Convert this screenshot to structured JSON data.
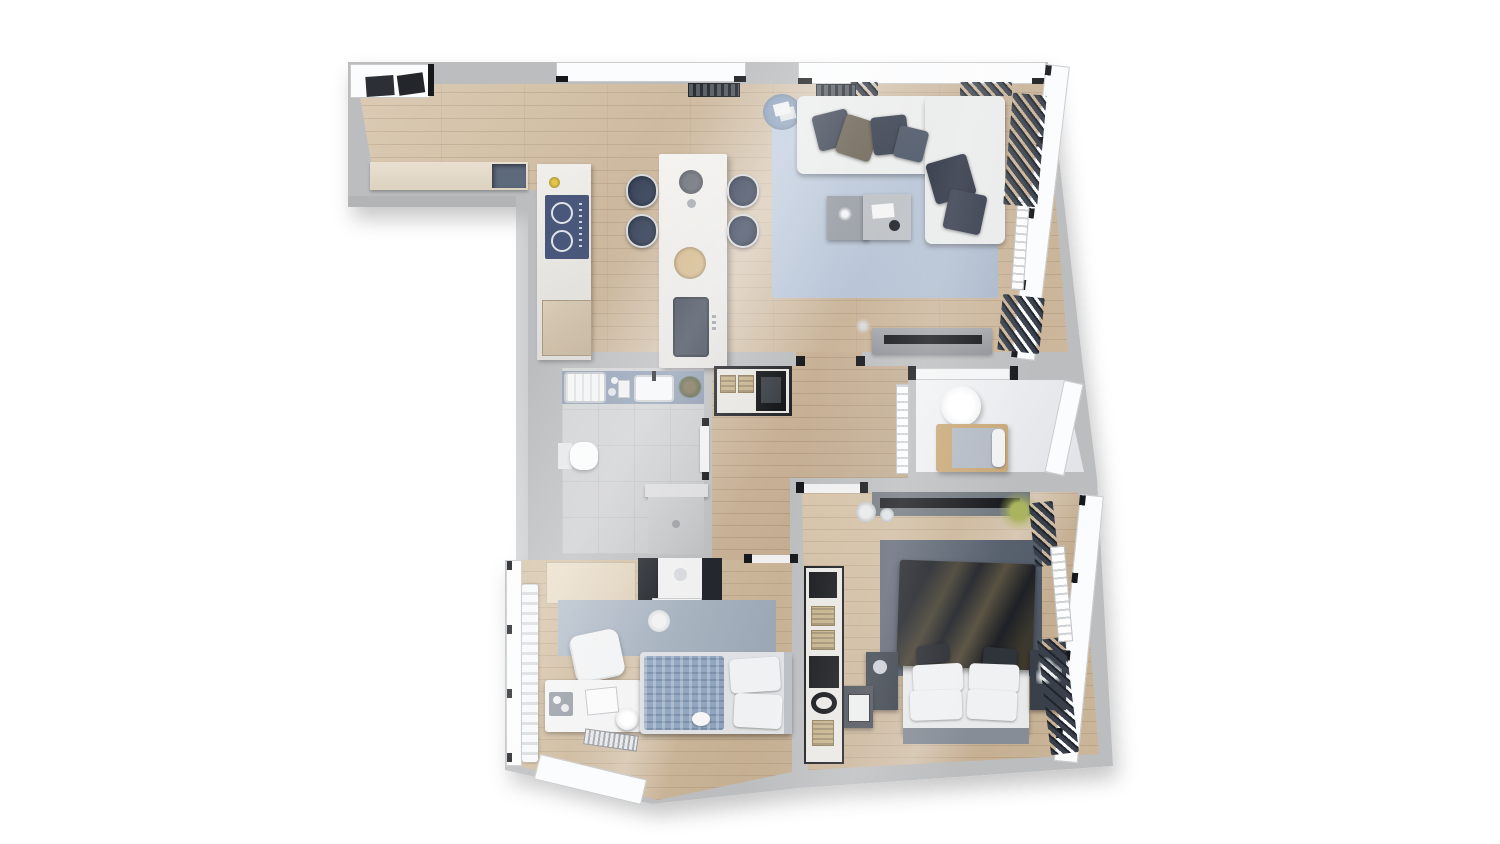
{
  "meta": {
    "type": "3d-rendered-floor-plan",
    "view": "top-down",
    "canvas": {
      "width": 1500,
      "height": 844
    },
    "visible_text": []
  },
  "palette": {
    "background": "#ffffff",
    "wall": "#bcbdbf",
    "innerWall": "#f2f3f4",
    "woodBase": "#c9b297",
    "tileBath": "#cbcccd",
    "balconyFloor": "#e9ebee",
    "rugLiving": "#b9c5d7",
    "rugMaster": "#58616e",
    "rugBedroom2": "#a8b3c0",
    "sofa": "#ebecec",
    "pillowNavy": "#333b4a",
    "pillowBrown": "#6b6354",
    "island": "#f1f0ed",
    "counter": "#e9e0d2",
    "stool": "#3b465c",
    "cooktop": "#49587a",
    "bathCounter": "#8b99ae",
    "blanketMaster": "#23262d",
    "blanketBedroom2": "#8da2bc",
    "curtainDark": "#39404b",
    "accentWoodFrame": "#c8a878",
    "applianceBlack": "#121418",
    "basket": "#c6b28b"
  },
  "rooms": [
    {
      "id": "kitchen-dining",
      "label": "Kitchen / Dining",
      "furniture": [
        "wall counter with sink",
        "induction cooktop counter",
        "oven cabinet",
        "kitchen island with sink",
        "four bar stools",
        "fruit bowl",
        "pendant lamp",
        "window radiator",
        "entry mats"
      ]
    },
    {
      "id": "living-room",
      "label": "Living Room",
      "furniture": [
        "L-shaped white sofa",
        "six cushions",
        "two nesting coffee tables",
        "large blue rug",
        "round side rug",
        "TV sideboard with TV",
        "wall radiator",
        "dark curtains"
      ]
    },
    {
      "id": "bathroom",
      "label": "Bathroom",
      "furniture": [
        "bathtub",
        "vanity counter with basin",
        "toilet",
        "walk-in shower",
        "plant",
        "candles"
      ]
    },
    {
      "id": "hallway",
      "label": "Hallway",
      "furniture": [
        "storage closet",
        "washing machine",
        "two wicker baskets",
        "radiator"
      ]
    },
    {
      "id": "balcony",
      "label": "Balcony",
      "furniture": [
        "round table",
        "wood-frame lounge daybed"
      ]
    },
    {
      "id": "master-bedroom",
      "label": "Master Bedroom",
      "furniture": [
        "double bed with dark blanket",
        "four white pillows",
        "two dark cushions",
        "two nightstands",
        "open wardrobe shelving",
        "wall TV console",
        "two vases",
        "palm plant",
        "dark rug",
        "radiator",
        "dark curtains",
        "side table with sewing machine"
      ]
    },
    {
      "id": "bedroom-2",
      "label": "Second Bedroom",
      "furniture": [
        "single bed with knit blanket",
        "desk",
        "desk chair",
        "round stool",
        "serving tray",
        "blue-grey rug",
        "wardrobe with dark cabinets",
        "built-in closet",
        "radiator",
        "white curtains"
      ]
    }
  ]
}
